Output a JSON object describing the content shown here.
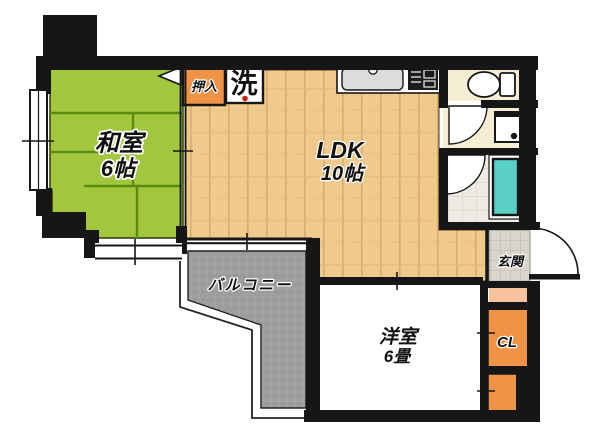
{
  "plan_type": "floorplan",
  "rooms": {
    "washitsu": {
      "label": "和室",
      "size": "6帖"
    },
    "ldk": {
      "label": "LDK",
      "size": "10帖"
    },
    "western": {
      "label": "洋室",
      "size": "6畳"
    },
    "balcony": {
      "label": "バルコニー"
    },
    "entrance": {
      "label": "玄関"
    },
    "closet": {
      "label": "CL"
    },
    "oshiire": {
      "label": "押入"
    },
    "laundry": {
      "label": "洗"
    }
  },
  "fixtures": [
    "kitchen-sink",
    "stove",
    "toilet",
    "washbasin",
    "bathtub",
    "washing-machine-pan",
    "entrance-door",
    "bath-door",
    "washroom-door",
    "oshiire-door-marker",
    "windows"
  ],
  "colors": {
    "tatami": "#a2c73e",
    "tatami_line": "#5c8a10",
    "wood_floor": "#f0ca8d",
    "wood_line": "#d9ab69",
    "closet_orange": "#ef9346",
    "step_peach": "#f6c39c",
    "bathtub_cyan": "#5acfc6",
    "balcony_gray": "#9e9e9e",
    "room_cream": "#f6edd5",
    "entrance_tile": "#d9d5cc",
    "wall_black": "#161616",
    "laundry_dot_red": "#cc2211"
  }
}
